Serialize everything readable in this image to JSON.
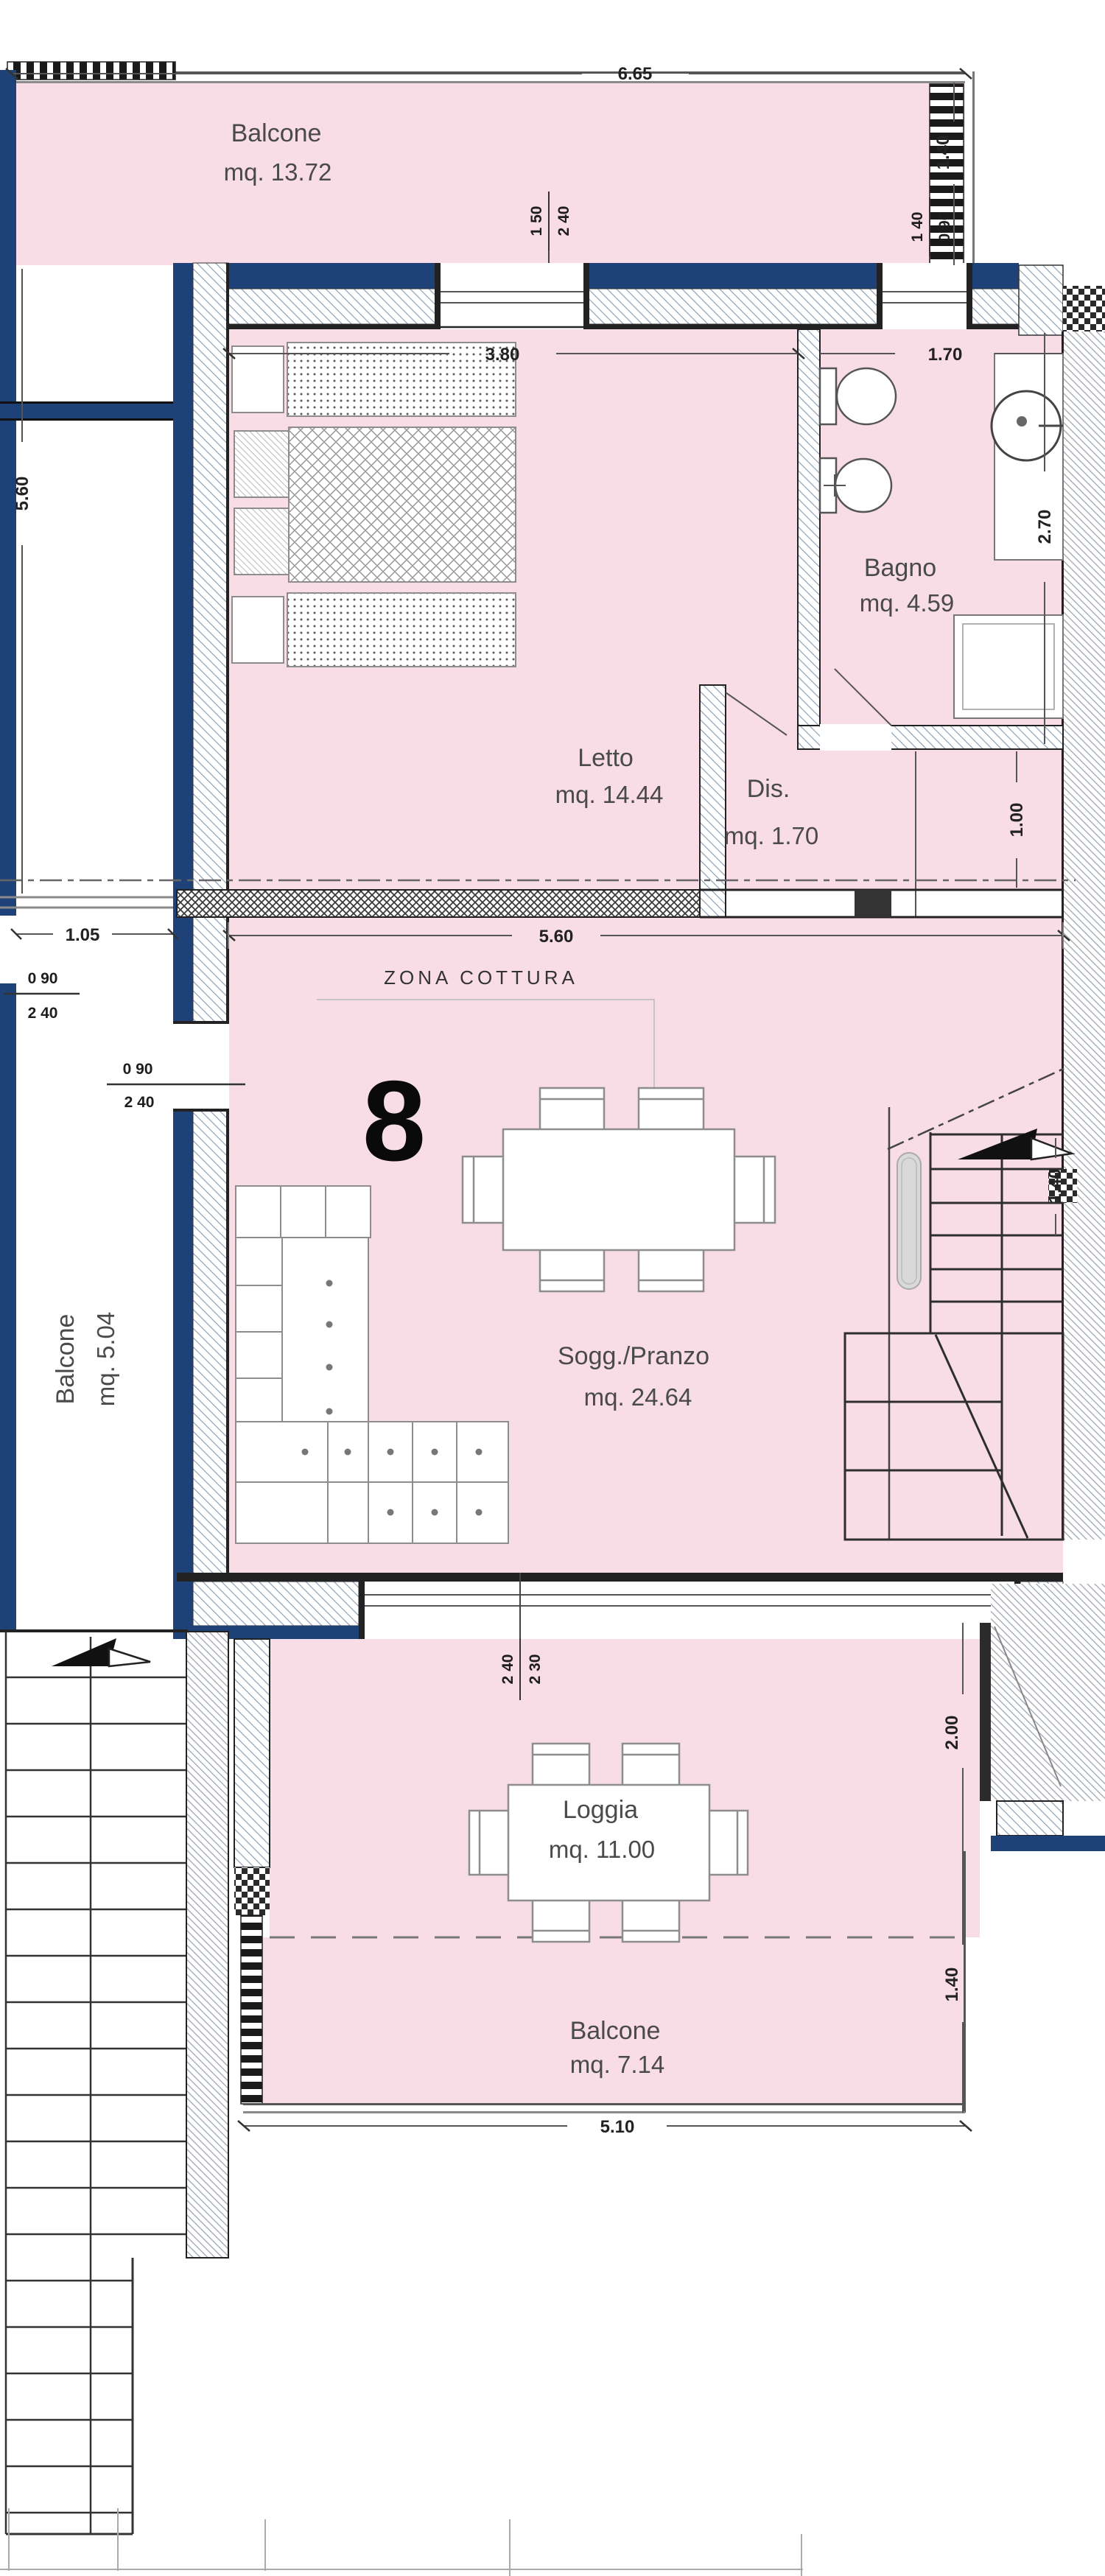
{
  "unit": {
    "number": "8"
  },
  "rooms": {
    "balcone_top": {
      "name": "Balcone",
      "area": "mq. 13.72"
    },
    "letto": {
      "name": "Letto",
      "area": "mq. 14.44"
    },
    "bagno": {
      "name": "Bagno",
      "area": "mq. 4.59"
    },
    "dis": {
      "name": "Dis.",
      "area": "mq. 1.70"
    },
    "soggiorno": {
      "name": "Sogg./Pranzo",
      "area": "mq. 24.64"
    },
    "zona_cottura": {
      "name": "ZONA COTTURA"
    },
    "balcone_left": {
      "name": "Balcone",
      "area": "mq. 5.04"
    },
    "loggia": {
      "name": "Loggia",
      "area": "mq. 11.00"
    },
    "balcone_bottom": {
      "name": "Balcone",
      "area": "mq. 7.14"
    }
  },
  "dimensions": {
    "top_width": "6.65",
    "balcony_depth": "1.40",
    "letto_window": {
      "w": "1 50",
      "h": "2 40"
    },
    "bagno_window": {
      "w": "1 40",
      "h": "0 90"
    },
    "letto_width": "3.80",
    "bagno_width": "1.70",
    "side_height": "5.60",
    "bagno_depth": "2.70",
    "dis_depth": "1.00",
    "interior_width": "5.60",
    "corridor_width": "1.05",
    "door_left": {
      "w": "0 90",
      "h": "2 40"
    },
    "door_balcony": {
      "w": "0 90",
      "h": "2 40"
    },
    "stair_width": "1.40",
    "sogg_window": {
      "w": "2 40",
      "h": "2 30"
    },
    "loggia_depth": "2.00",
    "balcone_depth": "1.40",
    "balcone_width": "5.10"
  },
  "colors": {
    "room_fill": "#f8dce6",
    "wall_navy": "#1e4278",
    "neighbor_hatch": "#9fa6ae"
  }
}
